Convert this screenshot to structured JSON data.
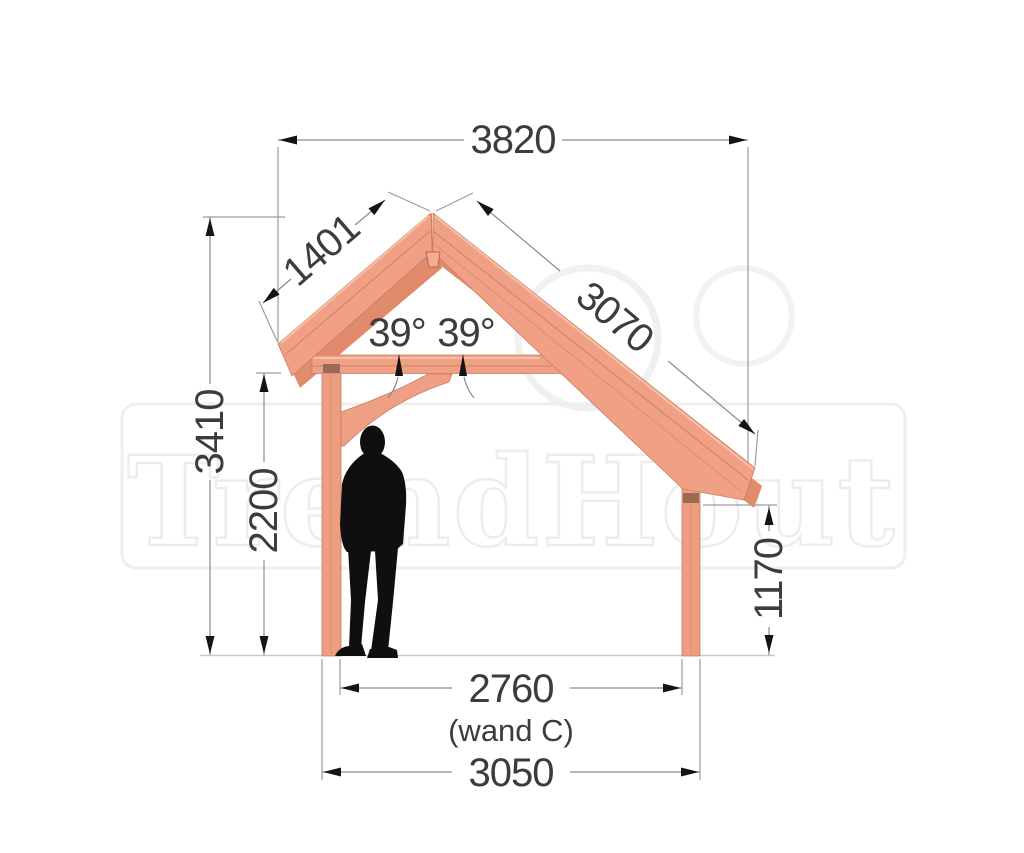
{
  "drawing": {
    "watermark_text": "TrendHout",
    "dimensions": {
      "top_width": "3820",
      "left_roof_slope": "1401",
      "right_roof_slope": "3070",
      "left_roof_angle": "39°",
      "right_roof_angle": "39°",
      "total_height": "3410",
      "clearance_height": "2200",
      "right_post_height": "1170",
      "inner_width": "2760",
      "inner_width_note": "(wand C)",
      "base_width": "3050"
    },
    "colors": {
      "wood_main": "#f0a085",
      "wood_shade": "#e18a6c",
      "wood_highlight": "#f7c0a5",
      "wood_seam": "#d08062",
      "connector_band": "#9b6a55",
      "dimension_line": "#8a8a8a",
      "extension_line": "#9c9c9c",
      "ground_line": "#c9c9c9",
      "arrow": "#141414",
      "text": "#3c3c3c",
      "watermark": "#ececec",
      "silhouette": "#0f0f0f"
    }
  }
}
